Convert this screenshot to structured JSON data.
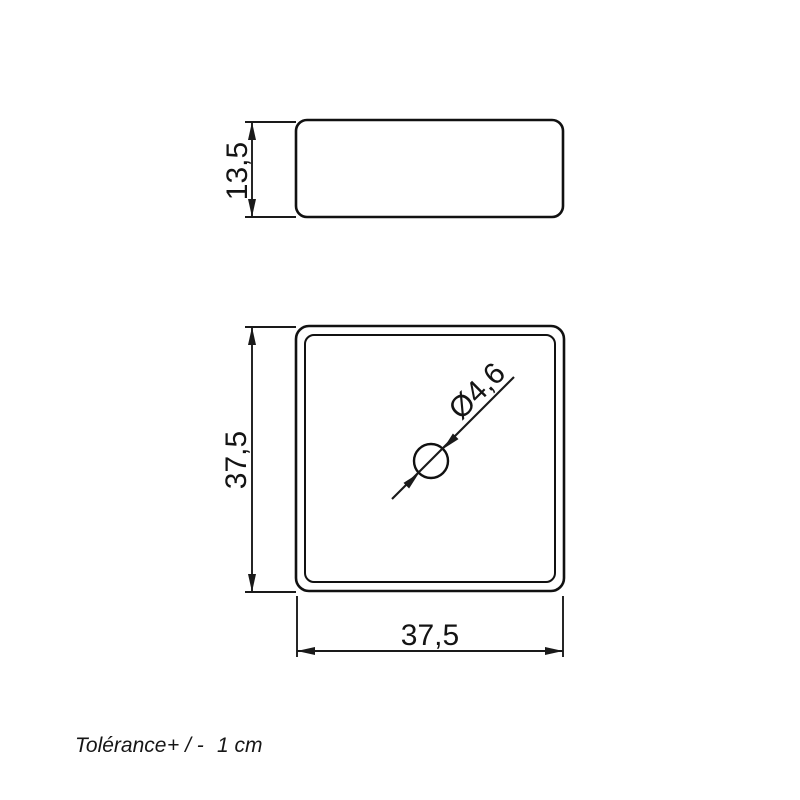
{
  "drawing": {
    "background": "#ffffff",
    "line_color": "#111111",
    "side_view": {
      "height_dim": "13,5"
    },
    "plan_view": {
      "height_dim": "37,5",
      "width_dim": "37,5",
      "hole_diameter_dim": "Ø4,6"
    },
    "tolerance": {
      "label": "Tolérance",
      "sign": "+ / -",
      "value": "1 cm"
    }
  }
}
